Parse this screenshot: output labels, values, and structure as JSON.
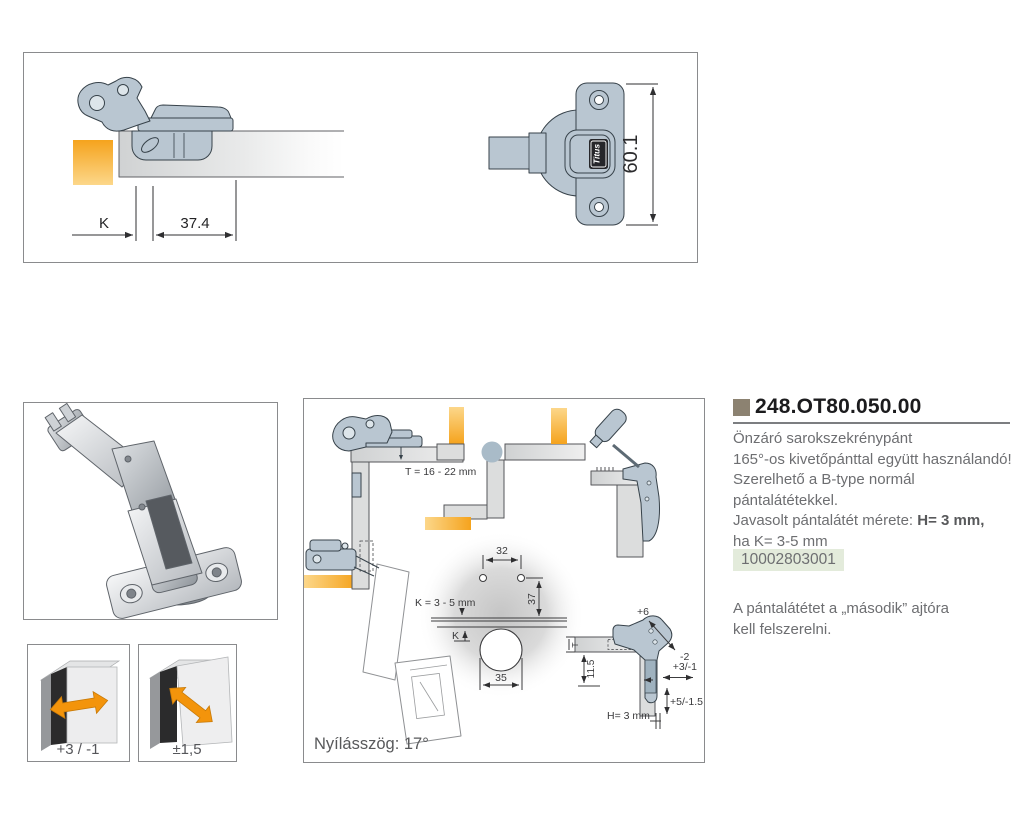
{
  "colors": {
    "accent_orange": "#f3940b",
    "hinge_blue_gray": "#b9c6d1",
    "order_code_bg": "#e3ebdb",
    "bullet_square": "#8c8271",
    "text_gray": "#6d6e71"
  },
  "top_drawing": {
    "dim_k": "K",
    "dim_depth": "37.4",
    "dim_height": "60.1",
    "logo_text": "Titus"
  },
  "diagram": {
    "panel_thickness": "T = 16 - 22 mm",
    "reveal_range": "K = 3 - 5 mm",
    "reveal_label": "K",
    "hole_spacing": "32",
    "hole_offset": "37",
    "cup_diameter": "35",
    "thickness_label": "T",
    "plate_height": "11.5",
    "adj_depth_plus": "+6",
    "adj_depth_minus": "-2",
    "adj_side": "+3/-1",
    "adj_height": "+5/-1.5",
    "spacer_height": "H= 3 mm",
    "opening_angle": "Nyílásszög: 17°"
  },
  "adjustment_icons": {
    "depth_adjust": "+3 / -1",
    "side_adjust": "±1,5"
  },
  "product": {
    "code": "248.OT80.050.00",
    "desc_line1": "Önzáró sarokszekrénypánt",
    "desc_line2": "165°-os kivetőpánttal együtt használandó!",
    "desc_line3": "Szerelhető a B-type normál",
    "desc_line4": "pántalátétekkel.",
    "desc_line5_normal": "Javasolt pántalátét mérete: ",
    "desc_line5_bold": "H= 3 mm,",
    "desc_line6": "ha K= 3-5 mm",
    "order_code": "10002803001",
    "note_line1": "A pántalátétet a „második” ajtóra",
    "note_line2": "kell felszerelni."
  }
}
